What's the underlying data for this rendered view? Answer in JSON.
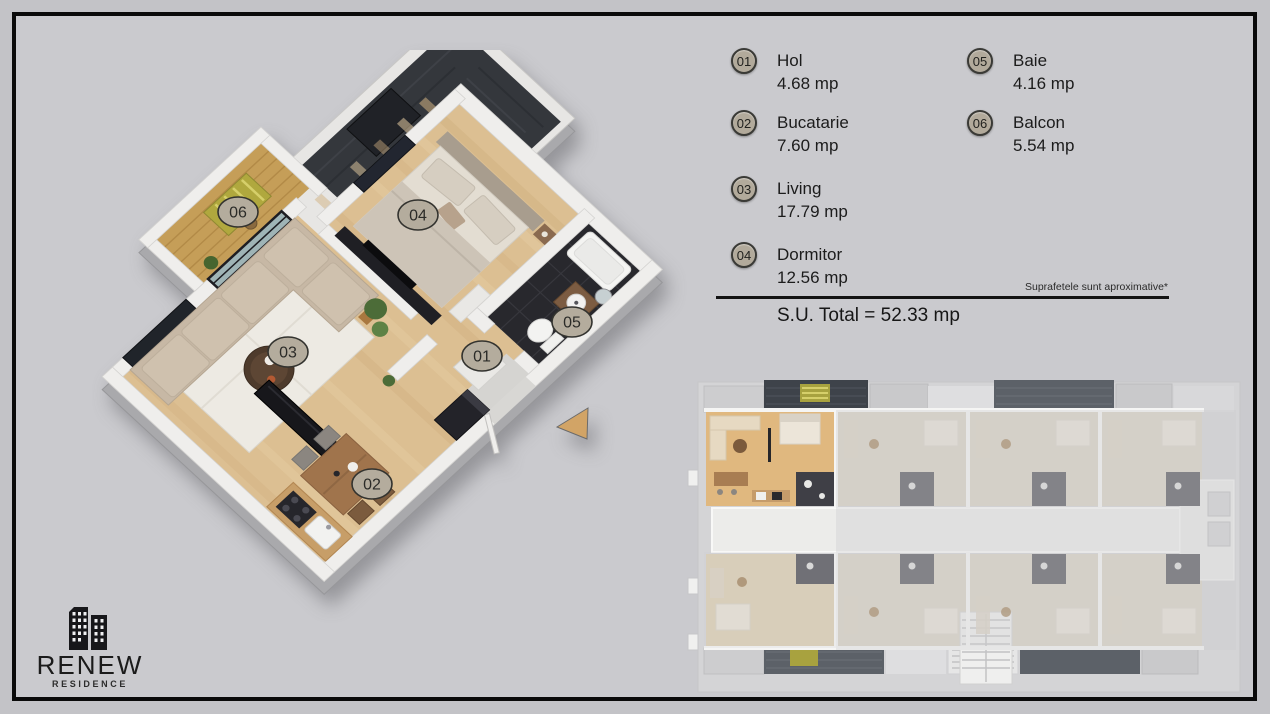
{
  "legend": {
    "items": [
      {
        "id": "01",
        "name": "Hol",
        "area": "4.68 mp"
      },
      {
        "id": "02",
        "name": "Bucatarie",
        "area": "7.60 mp"
      },
      {
        "id": "03",
        "name": "Living",
        "area": "17.79 mp"
      },
      {
        "id": "04",
        "name": "Dormitor",
        "area": "12.56 mp"
      },
      {
        "id": "05",
        "name": "Baie",
        "area": "4.16 mp"
      },
      {
        "id": "06",
        "name": "Balcon",
        "area": "5.54 mp"
      }
    ],
    "note": "Suprafetele sunt aproximative*",
    "total": "S.U. Total = 52.33 mp"
  },
  "plan3d": {
    "labels": {
      "hol": "01",
      "bucatarie": "02",
      "living": "03",
      "dormitor": "04",
      "baie": "05",
      "balcon": "06"
    }
  },
  "logo": {
    "title": "RENEW",
    "subtitle": "RESIDENCE"
  },
  "colors": {
    "background": "#c9c9cd",
    "frame": "#0a0a0a",
    "badge_fill": "#b2aa9b",
    "wood_floor": "#dcbf92",
    "balcony_wood": "#c59e58",
    "dark_tile": "#28282d",
    "roof_dark": "#34373c",
    "wall_white": "#efeeec",
    "highlight_unit_wood": "#e0b87f",
    "arrow_tan": "#d2a466",
    "text": "#1c1c1c"
  }
}
